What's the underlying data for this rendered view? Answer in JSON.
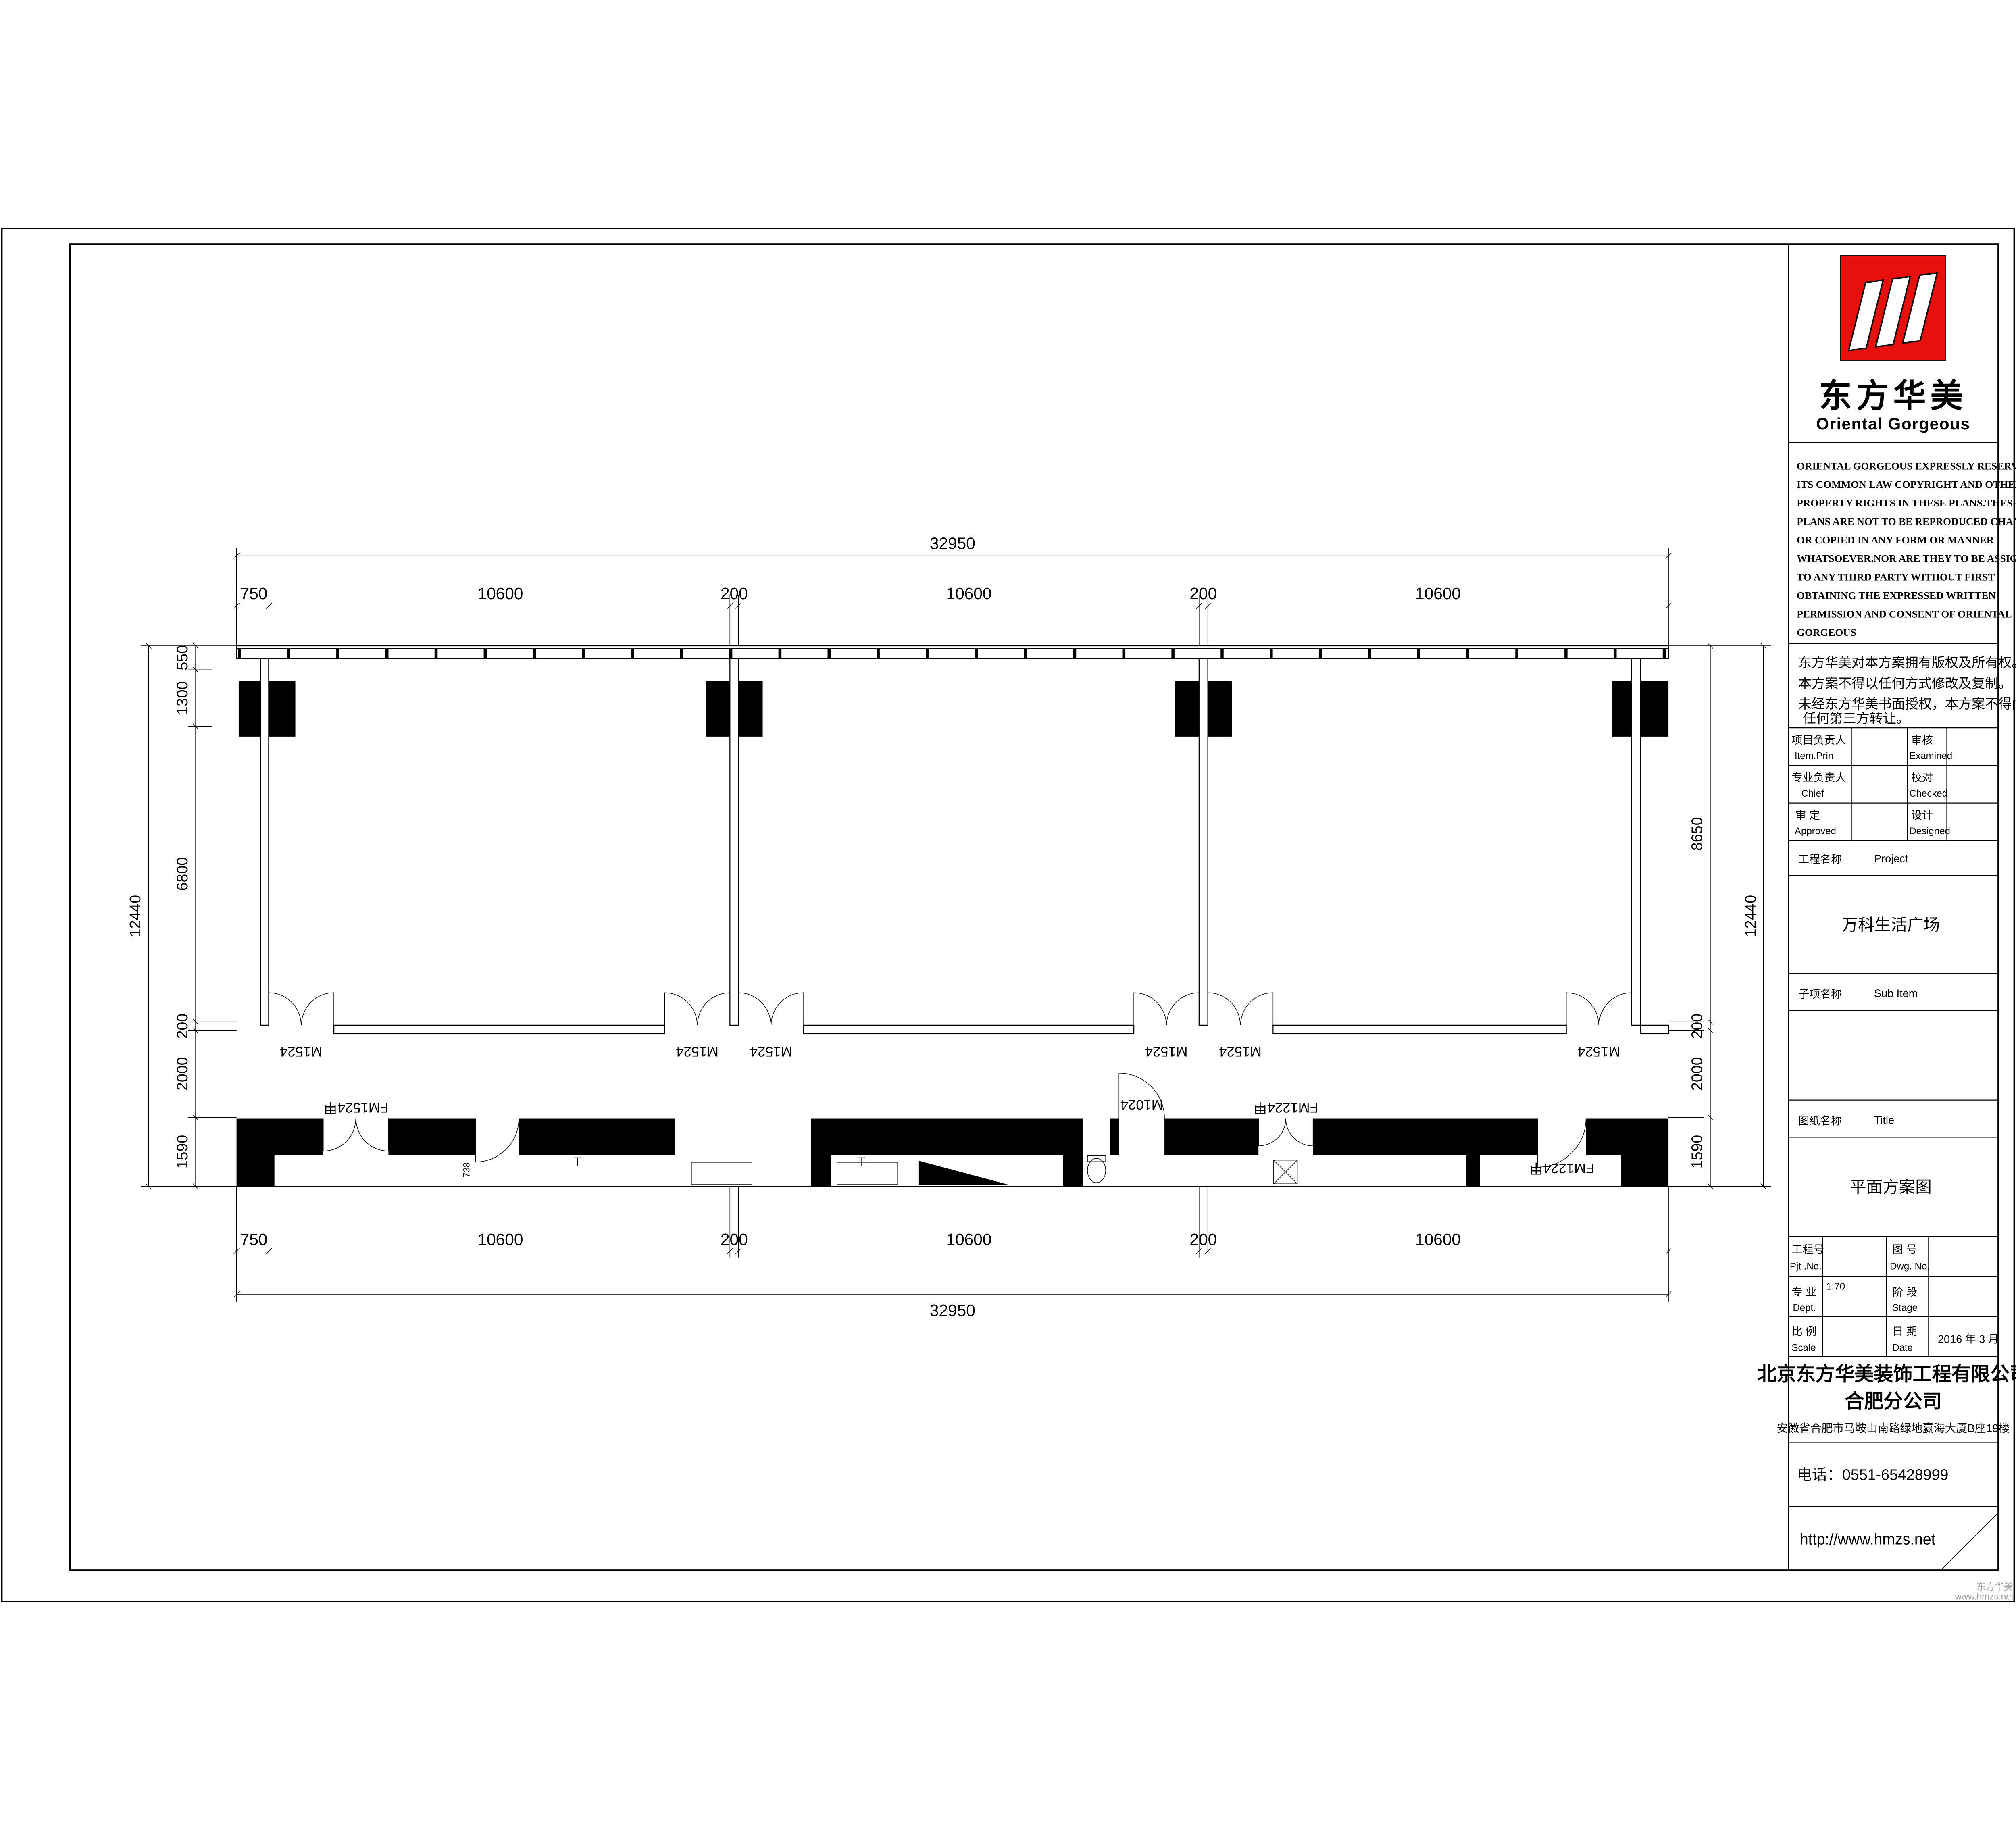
{
  "colors": {
    "paper": "#ffffff",
    "ink": "#000000",
    "logo_red": "#e8100c",
    "watermark_gray": "#9a9a9a"
  },
  "logo": {
    "name_cn": "东方华美",
    "name_en": "Oriental Gorgeous"
  },
  "copyright_en": [
    "ORIENTAL GORGEOUS EXPRESSLY RESERVES",
    "ITS COMMON LAW COPYRIGHT AND OTHER",
    "PROPERTY RIGHTS IN THESE PLANS.THESE",
    "PLANS ARE NOT TO BE REPRODUCED CHANGED",
    "OR COPIED IN ANY FORM OR MANNER",
    "WHATSOEVER.NOR ARE THEY TO BE ASSIGHED",
    "TO ANY THIRD PARTY WITHOUT FIRST",
    "OBTAINING THE EXPRESSED WRITTEN",
    "PERMISSION AND CONSENT OF ORIENTAL",
    "GORGEOUS"
  ],
  "copyright_cn": [
    "东方华美对本方案拥有版权及所有权。",
    "本方案不得以任何方式修改及复制。",
    "未经东方华美书面授权，本方案不得向",
    "任何第三方转让。"
  ],
  "approval_table": {
    "rows": [
      {
        "label_cn": "项目负责人",
        "label_en": "Item.Prin",
        "value": "",
        "label2_cn": "审核",
        "label2_en": "Examined",
        "value2": ""
      },
      {
        "label_cn": "专业负责人",
        "label_en": "Chief",
        "value": "",
        "label2_cn": "校对",
        "label2_en": "Checked",
        "value2": ""
      },
      {
        "label_cn": "审 定",
        "label_en": "Approved",
        "value": "",
        "label2_cn": "设计",
        "label2_en": "Designed",
        "value2": ""
      }
    ]
  },
  "project": {
    "label_cn": "工程名称",
    "label_en": "Project",
    "value": "万科生活广场"
  },
  "sub_item": {
    "label_cn": "子项名称",
    "label_en": "Sub Item",
    "value": ""
  },
  "drawing_title": {
    "label_cn": "图纸名称",
    "label_en": "Title",
    "value": "平面方案图"
  },
  "info_table": {
    "pjt": {
      "label_cn": "工程号",
      "label_en": "Pjt .No.",
      "value": ""
    },
    "dwg": {
      "label_cn": "图 号",
      "label_en": "Dwg. No.",
      "value": ""
    },
    "dept": {
      "label_cn": "专 业",
      "label_en": "Dept.",
      "value": "1:70"
    },
    "stage": {
      "label_cn": "阶 段",
      "label_en": "Stage",
      "value": ""
    },
    "scale": {
      "label_cn": "比 例",
      "label_en": "Scale",
      "value": ""
    },
    "date": {
      "label_cn": "日 期",
      "label_en": "Date",
      "value": "2016 年 3  月"
    }
  },
  "company": {
    "name": "北京东方华美装饰工程有限公司",
    "branch": "合肥分公司",
    "address": "安徽省合肥市马鞍山南路绿地赢海大厦B座19楼",
    "phone": "电话：0551-65428999",
    "website": "http://www.hmzs.net"
  },
  "watermark": {
    "line1": "东方华美",
    "line2": "www.hmzs.net"
  },
  "plan": {
    "dim_overall_h": "32950",
    "dims_h": [
      "750",
      "10600",
      "200",
      "10600",
      "200",
      "10600"
    ],
    "dim_overall_v": "12440",
    "dims_v_left": [
      "550",
      "1300",
      "6800",
      "200",
      "2000",
      "1590"
    ],
    "dims_v_right": [
      "8650",
      "200",
      "2000",
      "1590"
    ],
    "door_labels_mid": [
      "M1524",
      "M1524",
      "M1524",
      "M1524",
      "M1524",
      "M1524"
    ],
    "door_labels_bottom": [
      "FM1524甲",
      "FM1024甲",
      "M1024",
      "FM1224甲",
      "FM1224甲"
    ],
    "small_dim": "738"
  }
}
